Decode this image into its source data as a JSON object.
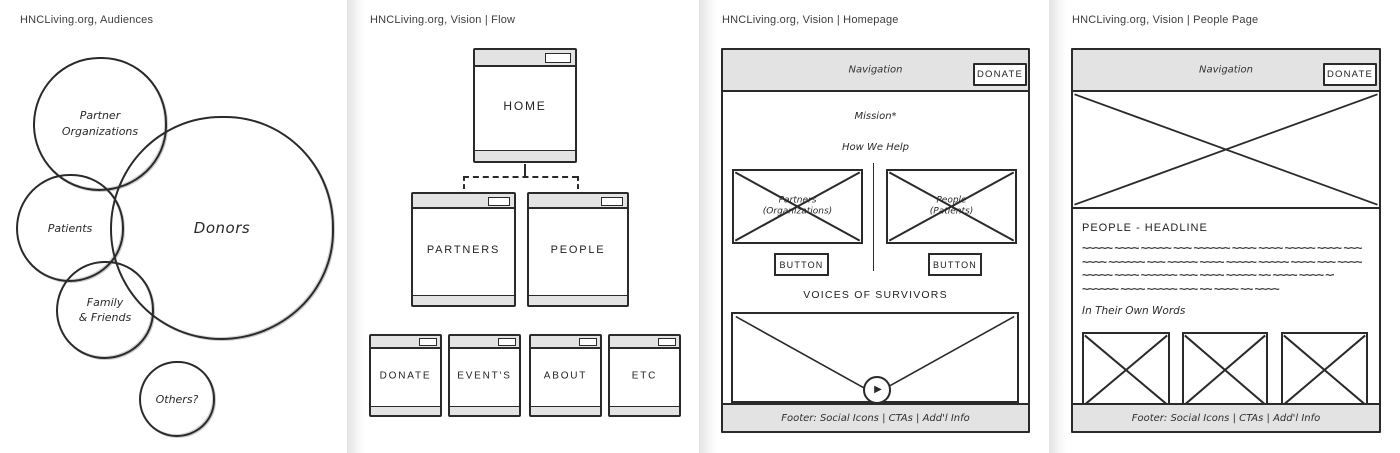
{
  "colors": {
    "stroke": "#2a2a2a",
    "bar_gray": "#e3e3e3",
    "title_text": "#3d3d3d"
  },
  "audiences": {
    "title": "HNCLiving.org, Audiences",
    "circles": {
      "partner_orgs": "Partner\nOrganizations",
      "patients": "Patients",
      "donors": "Donors",
      "family_friends": "Family\n& Friends",
      "others": "Others?"
    }
  },
  "flow": {
    "title": "HNCLiving.org, Vision | Flow",
    "nodes": {
      "home": "HOME",
      "partners": "PARTNERS",
      "people": "PEOPLE",
      "donate": "DONATE",
      "events": "EVENT'S",
      "about": "ABOUT",
      "etc": "ETC"
    }
  },
  "homepage": {
    "title": "HNCLiving.org, Vision | Homepage",
    "nav_label": "Navigation",
    "donate_button": "DONATE",
    "mission_heading": "Mission*",
    "how_we_help_heading": "How We Help",
    "partners_caption": "Partners\n(Organizations)",
    "people_caption": "People\n(Patients)",
    "partners_button": "BUTTON",
    "people_button": "BUTTON",
    "voices_heading": "VOICES OF SURVIVORS",
    "footer": "Footer: Social Icons | CTAs | Add'l Info"
  },
  "people_page": {
    "title": "HNCLiving.org, Vision | People Page",
    "nav_label": "Navigation",
    "donate_button": "DONATE",
    "headline": "PEOPLE - HEADLINE",
    "scribble_lines": [
      "~~~~~ ~~~~ ~~~~~ ~~~ ~~~~~~ ~~~~ ~~~~ ~~~~~ ~~~~ ~~~",
      "~~~~ ~~~~~~ ~~~ ~~~~~ ~~~~ ~~~~~ ~~~~~ ~~~~ ~~~ ~~~~",
      "~~~~~ ~~~~ ~~~~~~ ~~~ ~~~~ ~~~~~ ~~ ~~~~ ~~~~ ~~~",
      "~~~~~~ ~~~~ ~~~~~ ~~~ ~~ ~~~~ ~~ ~~~~"
    ],
    "own_words_heading": "In Their Own Words",
    "footer": "Footer: Social Icons | CTAs | Add'l Info"
  }
}
